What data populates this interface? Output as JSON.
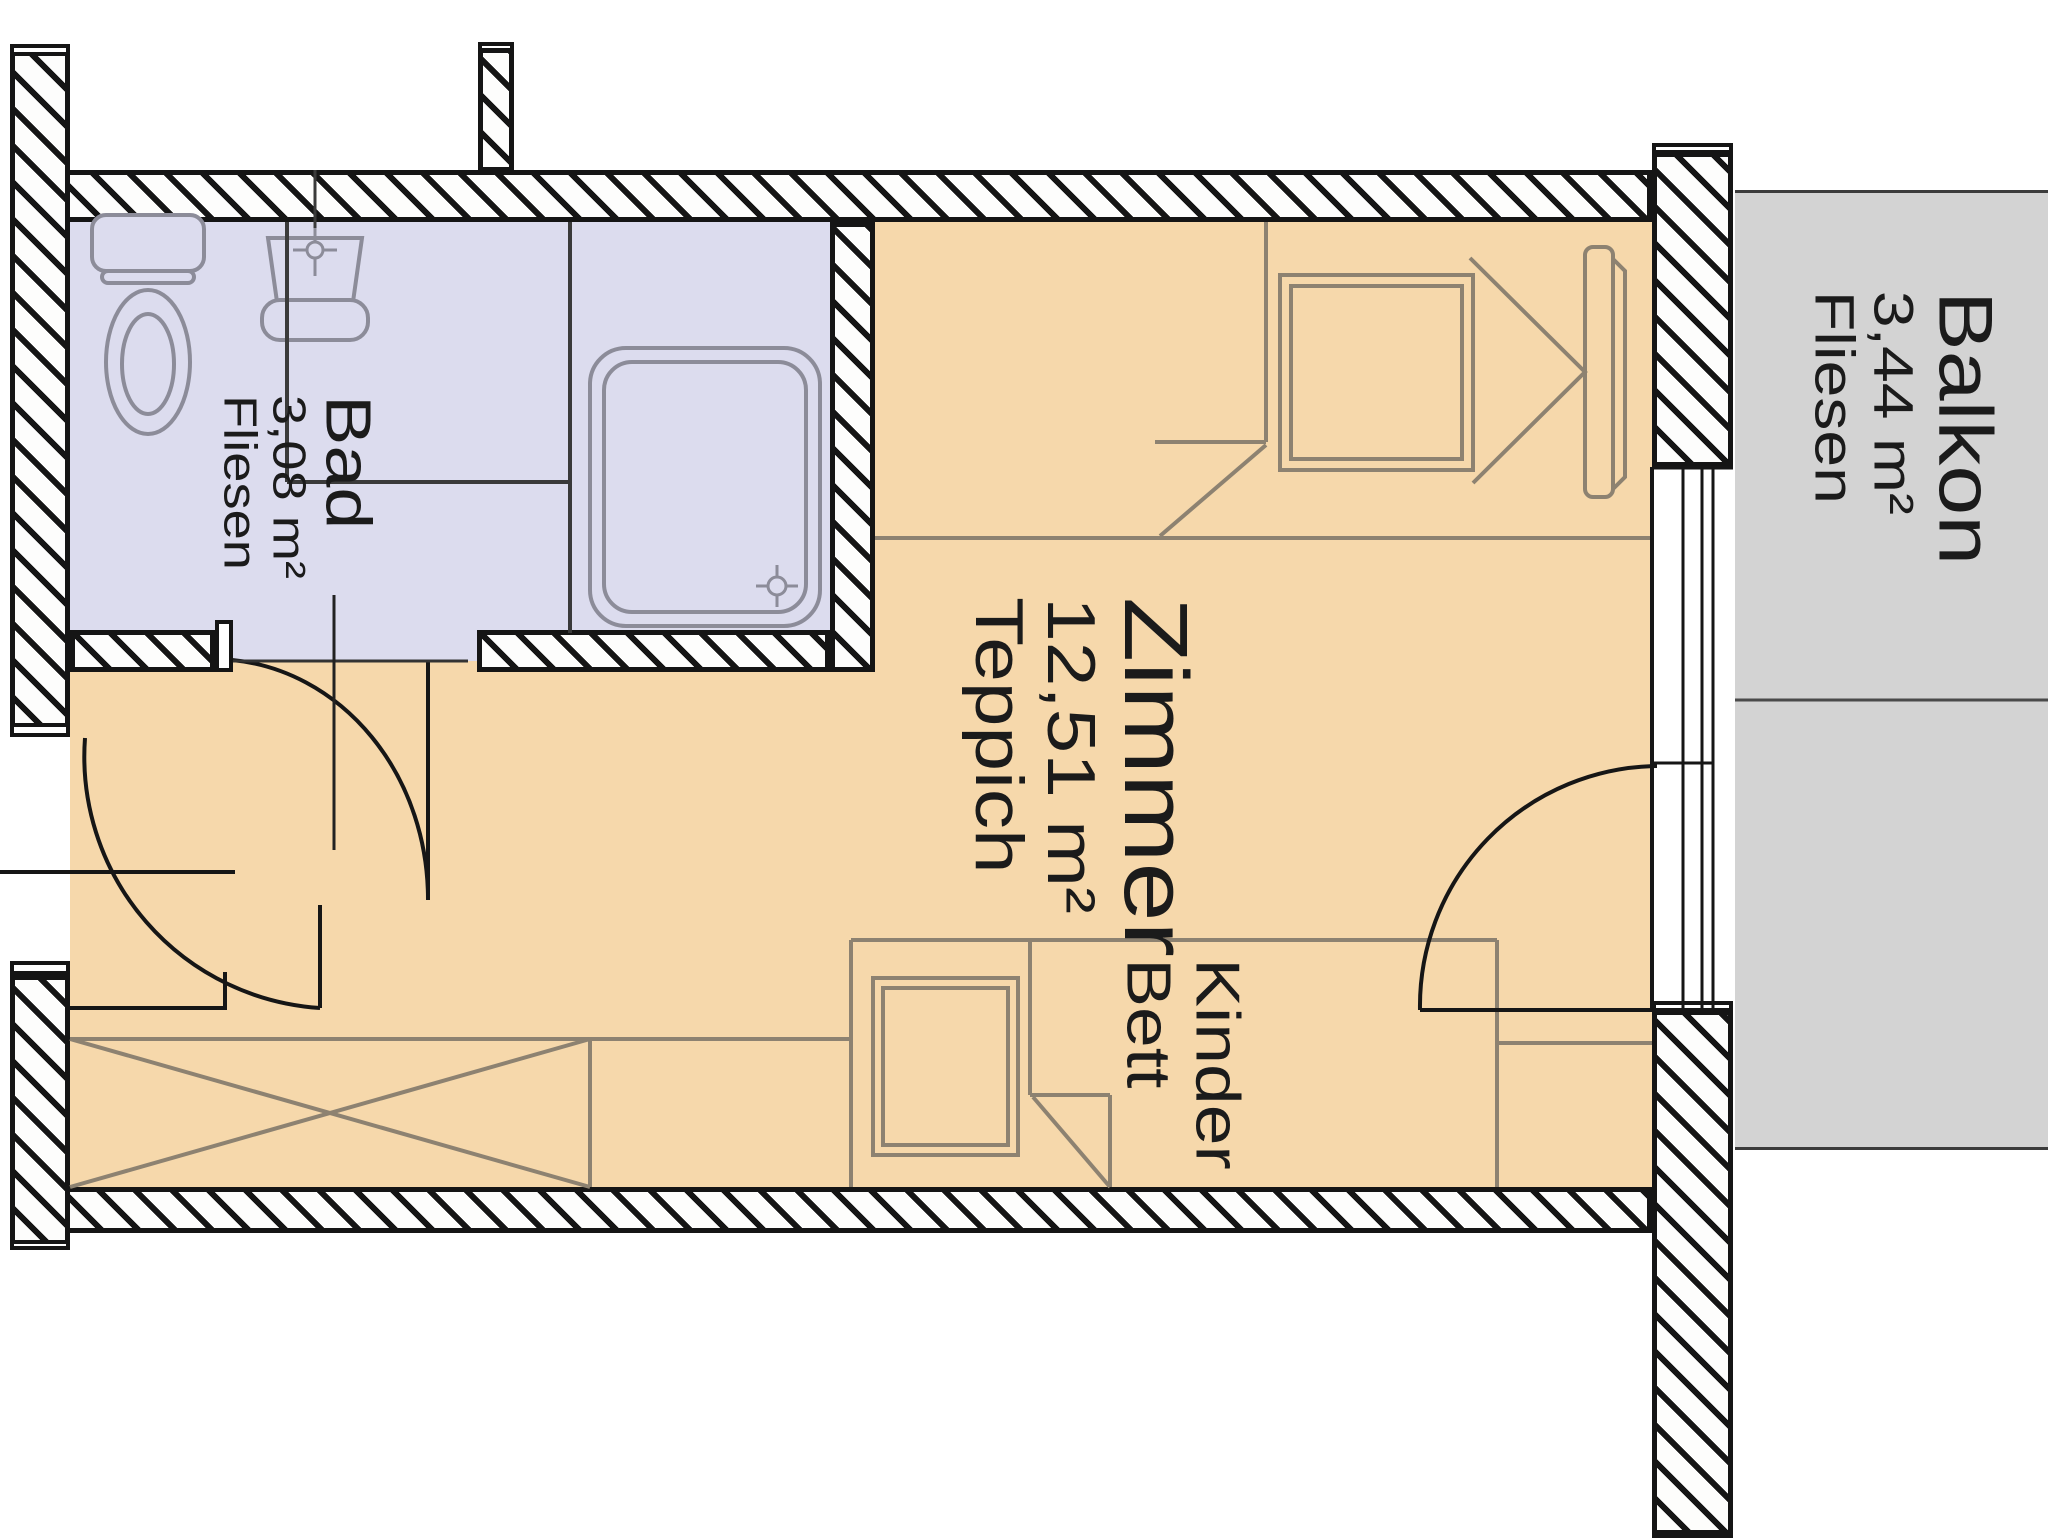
{
  "plan": {
    "type": "floor-plan",
    "rooms": [
      {
        "id": "bad",
        "name": "Bad",
        "area": "3,08 m²",
        "floor_material": "Fliesen"
      },
      {
        "id": "zimmer",
        "name": "Zimmer",
        "area": "12,51 m²",
        "floor_material": "Teppich"
      },
      {
        "id": "balkon",
        "name": "Balkon",
        "area": "3,44 m²",
        "floor_material": "Fliesen"
      }
    ],
    "furniture_labels": [
      {
        "id": "kinder-bett",
        "line1": "Kinder",
        "line2": "Bett"
      }
    ],
    "colors": {
      "room_floor": "#f6d8ab",
      "bath_floor": "#dcdcee",
      "balcony_floor": "#d3d3d3",
      "wall_line": "#151515",
      "furniture_line": "#8d8271",
      "fixture_line": "#8c8c99"
    }
  }
}
